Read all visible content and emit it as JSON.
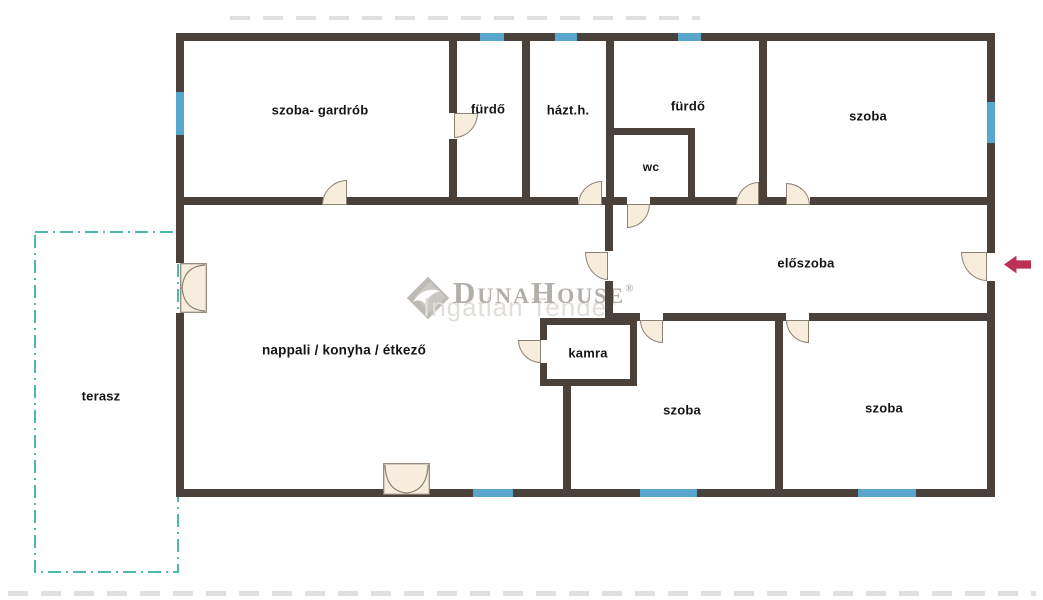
{
  "canvas": {
    "width": 1043,
    "height": 600,
    "background": "#ffffff"
  },
  "colors": {
    "wall": "#4a413a",
    "window": "#58a5cd",
    "door_fill": "#f6eddd",
    "door_stroke": "#8c8177",
    "terrace": "#4cb8ae",
    "arrow": "#bb3156",
    "label": "#141414",
    "watermark_text": "#a5a19c",
    "watermark_echo": "#dcd8d2",
    "stripe": "#d8d6d3"
  },
  "rooms": [
    {
      "label": "szoba- gardrób",
      "cx": 320,
      "cy": 110,
      "fs": 13
    },
    {
      "label": "fürdő",
      "cx": 488,
      "cy": 109,
      "fs": 13
    },
    {
      "label": "házt.h.",
      "cx": 568,
      "cy": 110,
      "fs": 13
    },
    {
      "label": "fürdő",
      "cx": 688,
      "cy": 106,
      "fs": 13
    },
    {
      "label": "wc",
      "cx": 651,
      "cy": 167,
      "fs": 12
    },
    {
      "label": "szoba",
      "cx": 868,
      "cy": 116,
      "fs": 13
    },
    {
      "label": "előszoba",
      "cx": 806,
      "cy": 263,
      "fs": 13
    },
    {
      "label": "nappali / konyha / étkező",
      "cx": 344,
      "cy": 350,
      "fs": 13.5
    },
    {
      "label": "kamra",
      "cx": 588,
      "cy": 353,
      "fs": 13
    },
    {
      "label": "szoba",
      "cx": 682,
      "cy": 410,
      "fs": 13
    },
    {
      "label": "szoba",
      "cx": 884,
      "cy": 408,
      "fs": 13
    },
    {
      "label": "terasz",
      "cx": 101,
      "cy": 396,
      "fs": 13
    }
  ],
  "walls": [
    [
      176,
      33,
      819,
      8
    ],
    [
      176,
      489,
      819,
      8
    ],
    [
      176,
      33,
      8,
      230
    ],
    [
      176,
      313,
      8,
      184
    ],
    [
      987,
      33,
      8,
      220
    ],
    [
      987,
      281,
      8,
      216
    ],
    [
      449,
      41,
      8,
      72
    ],
    [
      449,
      139,
      8,
      66
    ],
    [
      522,
      41,
      8,
      164
    ],
    [
      606,
      41,
      8,
      164
    ],
    [
      605,
      205,
      8,
      46
    ],
    [
      605,
      281,
      8,
      40
    ],
    [
      759,
      41,
      8,
      164
    ],
    [
      609,
      128,
      86,
      7
    ],
    [
      688,
      135,
      7,
      70
    ],
    [
      176,
      197,
      147,
      8
    ],
    [
      347,
      197,
      231,
      8
    ],
    [
      602,
      197,
      25,
      8
    ],
    [
      650,
      197,
      87,
      8
    ],
    [
      760,
      197,
      26,
      8
    ],
    [
      810,
      197,
      185,
      8
    ],
    [
      607,
      313,
      33,
      8
    ],
    [
      663,
      313,
      123,
      8
    ],
    [
      809,
      313,
      186,
      8
    ],
    [
      775,
      321,
      8,
      168
    ],
    [
      563,
      386,
      8,
      103
    ],
    [
      540,
      318,
      97,
      7
    ],
    [
      540,
      379,
      97,
      7
    ],
    [
      540,
      325,
      7,
      15
    ],
    [
      540,
      363,
      7,
      16
    ],
    [
      630,
      325,
      7,
      54
    ]
  ],
  "windows": [
    [
      480,
      33,
      24,
      8
    ],
    [
      555,
      33,
      22,
      8
    ],
    [
      678,
      33,
      23,
      8
    ],
    [
      176,
      92,
      8,
      43
    ],
    [
      987,
      102,
      8,
      41
    ],
    [
      473,
      489,
      40,
      8
    ],
    [
      640,
      489,
      57,
      8
    ],
    [
      858,
      489,
      58,
      8
    ]
  ],
  "doors": [
    {
      "x": 322,
      "y": 180,
      "w": 25,
      "h": 25,
      "round": "tl"
    },
    {
      "x": 454,
      "y": 113,
      "w": 24,
      "h": 25,
      "round": "br"
    },
    {
      "x": 578,
      "y": 181,
      "w": 24,
      "h": 24,
      "round": "tl"
    },
    {
      "x": 627,
      "y": 204,
      "w": 23,
      "h": 24,
      "round": "br"
    },
    {
      "x": 736,
      "y": 182,
      "w": 23,
      "h": 23,
      "round": "tl"
    },
    {
      "x": 786,
      "y": 183,
      "w": 24,
      "h": 22,
      "round": "tr"
    },
    {
      "x": 585,
      "y": 252,
      "w": 23,
      "h": 28,
      "round": "bl"
    },
    {
      "x": 961,
      "y": 252,
      "w": 26,
      "h": 29,
      "round": "bl"
    },
    {
      "x": 640,
      "y": 320,
      "w": 23,
      "h": 23,
      "round": "bl"
    },
    {
      "x": 786,
      "y": 320,
      "w": 23,
      "h": 23,
      "round": "bl"
    },
    {
      "x": 518,
      "y": 340,
      "w": 23,
      "h": 23,
      "round": "bl"
    }
  ],
  "french_doors": [
    {
      "x": 180,
      "y": 263,
      "w": 27,
      "h": 50,
      "dir": "left-wall"
    },
    {
      "x": 383,
      "y": 463,
      "w": 47,
      "h": 32,
      "dir": "bottom-wall"
    }
  ],
  "terrace": {
    "x": 35,
    "y": 232,
    "w": 143,
    "h": 340
  },
  "entry_arrow": {
    "x": 1004,
    "y": 255,
    "w": 27,
    "h": 19
  },
  "watermark": {
    "text": "DunaHouse",
    "reg": "®",
    "echo": "Ingatlan Tender"
  },
  "stripes": [
    {
      "x": 230,
      "y": 16,
      "w": 470,
      "h": 4
    },
    {
      "x": 8,
      "y": 591,
      "w": 1028,
      "h": 5
    }
  ]
}
